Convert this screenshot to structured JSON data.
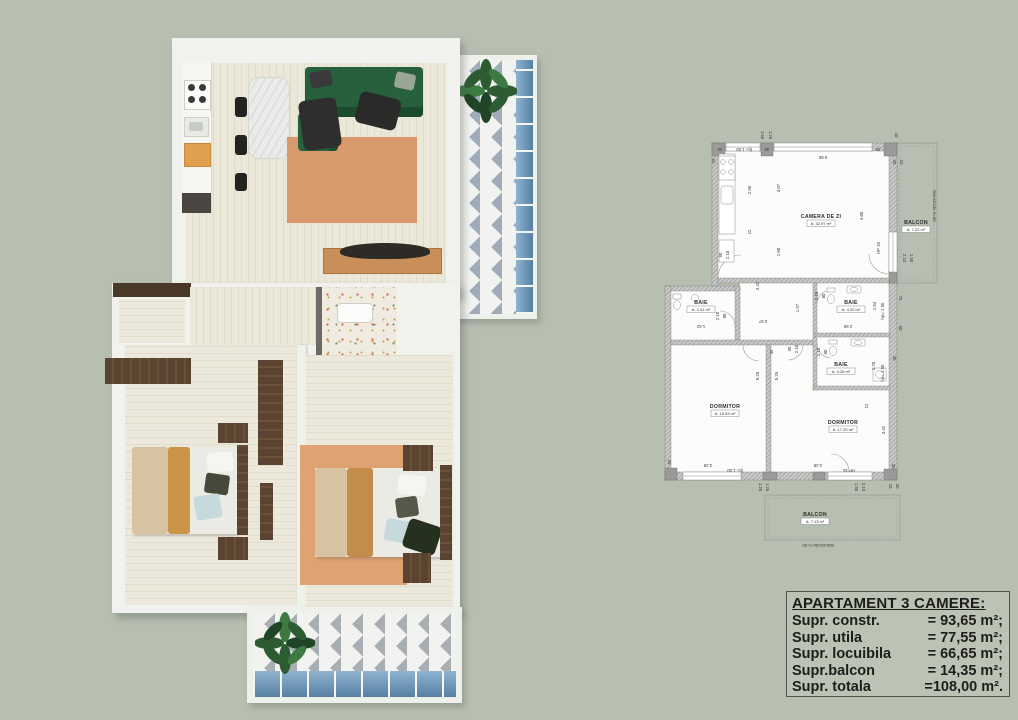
{
  "palette": {
    "page_bg": "#b7bfb1",
    "wall_white": "#f1f2ee",
    "sofa_green": "#26613b",
    "rug_terracotta": "#d89a6c",
    "accent_orange": "#e0a050",
    "dark_wood": "#5a4330",
    "balcony_blue": "#7fa5c4",
    "plan_line": "#8a8a88"
  },
  "plan2d": {
    "rooms": [
      {
        "name": "CAMERA DE ZI",
        "area": "A: 32.97 m²",
        "x": 158,
        "y": 90
      },
      {
        "name": "BAIE",
        "area": "A: 2.41 m²",
        "x": 38,
        "y": 176
      },
      {
        "name": "BAIE",
        "area": "A: 4.20 m²",
        "x": 188,
        "y": 176
      },
      {
        "name": "BAIE",
        "area": "A: 4.28 m²",
        "x": 178,
        "y": 238
      },
      {
        "name": "DORMITOR",
        "area": "A: 16.53 m²",
        "x": 62,
        "y": 280
      },
      {
        "name": "DORMITOR",
        "area": "A: 17.20 m²",
        "x": 180,
        "y": 296
      },
      {
        "name": "BALCON",
        "area": "A: 7.22 m²",
        "x": 253,
        "y": 96
      },
      {
        "name": "BALCON",
        "area": "A: 7.13 m²",
        "x": 152,
        "y": 388
      }
    ],
    "railings": [
      {
        "text": "Balustrada H=90",
        "x": 270,
        "y": 78,
        "rot": 90
      },
      {
        "text": "Balustrada H=90",
        "x": 155,
        "y": 416,
        "rot": 180
      }
    ],
    "dims": [
      {
        "t": "1.50",
        "x": 98,
        "y": 7,
        "r": 90
      },
      {
        "t": "1.25",
        "x": 106,
        "y": 7,
        "r": 90
      },
      {
        "t": "10",
        "x": 232,
        "y": 7,
        "r": 90
      },
      {
        "t": "30",
        "x": 57,
        "y": 20,
        "r": 180
      },
      {
        "t": "fp= 1.00",
        "x": 81,
        "y": 20,
        "r": 180
      },
      {
        "t": "30",
        "x": 104,
        "y": 20,
        "r": 180
      },
      {
        "t": "5.85",
        "x": 160,
        "y": 28,
        "r": 180
      },
      {
        "t": "30",
        "x": 215,
        "y": 20,
        "r": 180
      },
      {
        "t": "30",
        "x": 230,
        "y": 34,
        "r": 90
      },
      {
        "t": "10",
        "x": 237,
        "y": 34,
        "r": 90
      },
      {
        "t": "25",
        "x": 52,
        "y": 33,
        "r": -90
      },
      {
        "t": "2.95",
        "x": 88,
        "y": 62,
        "r": -90
      },
      {
        "t": "3.07",
        "x": 117,
        "y": 60,
        "r": -90
      },
      {
        "t": "12",
        "x": 88,
        "y": 104,
        "r": -90
      },
      {
        "t": "90",
        "x": 59,
        "y": 127,
        "r": -90
      },
      {
        "t": "2.10",
        "x": 66,
        "y": 127,
        "r": -90
      },
      {
        "t": "1.60",
        "x": 117,
        "y": 124,
        "r": -90
      },
      {
        "t": "4.80",
        "x": 200,
        "y": 88,
        "r": -90
      },
      {
        "t": "HP 15",
        "x": 217,
        "y": 120,
        "r": -90
      },
      {
        "t": "2.10",
        "x": 240,
        "y": 130,
        "r": 90
      },
      {
        "t": "1.50",
        "x": 247,
        "y": 130,
        "r": 90
      },
      {
        "t": "3.42",
        "x": 96,
        "y": 158,
        "r": -90
      },
      {
        "t": "1.97",
        "x": 136,
        "y": 180,
        "r": -90
      },
      {
        "t": "2.10",
        "x": 155,
        "y": 168,
        "r": -90
      },
      {
        "t": "80",
        "x": 162,
        "y": 168,
        "r": -90
      },
      {
        "t": "2.87",
        "x": 100,
        "y": 192,
        "r": 180
      },
      {
        "t": "1.62",
        "x": 38,
        "y": 197,
        "r": 180
      },
      {
        "t": "2.10",
        "x": 56,
        "y": 188,
        "r": -90
      },
      {
        "t": "80",
        "x": 63,
        "y": 188,
        "r": -90
      },
      {
        "t": "90",
        "x": 128,
        "y": 221,
        "r": -90
      },
      {
        "t": "2.10",
        "x": 135,
        "y": 221,
        "r": -90
      },
      {
        "t": "2.55",
        "x": 185,
        "y": 197,
        "r": 180
      },
      {
        "t": "1.94",
        "x": 213,
        "y": 178,
        "r": -90
      },
      {
        "t": "hp= 1.50",
        "x": 221,
        "y": 183,
        "r": -90
      },
      {
        "t": "2.10",
        "x": 157,
        "y": 224,
        "r": -90
      },
      {
        "t": "80",
        "x": 164,
        "y": 224,
        "r": -90
      },
      {
        "t": "1.70",
        "x": 212,
        "y": 238,
        "r": -90
      },
      {
        "t": "hp= 1.50",
        "x": 221,
        "y": 245,
        "r": -90
      },
      {
        "t": "12",
        "x": 205,
        "y": 278,
        "r": -90
      },
      {
        "t": "75",
        "x": 236,
        "y": 170,
        "r": 90
      },
      {
        "t": "60",
        "x": 236,
        "y": 200,
        "r": 90
      },
      {
        "t": "30",
        "x": 230,
        "y": 230,
        "r": 90
      },
      {
        "t": "5.25",
        "x": 96,
        "y": 248,
        "r": -90
      },
      {
        "t": "5.25",
        "x": 115,
        "y": 248,
        "r": -90
      },
      {
        "t": "3.42",
        "x": 222,
        "y": 302,
        "r": -90
      },
      {
        "t": "3.28",
        "x": 45,
        "y": 336,
        "r": 180
      },
      {
        "t": "fp= 1.00",
        "x": 72,
        "y": 341,
        "r": 180
      },
      {
        "t": "4.28",
        "x": 155,
        "y": 336,
        "r": 180
      },
      {
        "t": "HP 15",
        "x": 186,
        "y": 341,
        "r": 180
      },
      {
        "t": "25",
        "x": 5,
        "y": 334,
        "r": 90
      },
      {
        "t": "30",
        "x": 229,
        "y": 338,
        "r": 90
      },
      {
        "t": "1.20",
        "x": 96,
        "y": 359,
        "r": 90
      },
      {
        "t": "1.25",
        "x": 103,
        "y": 359,
        "r": 90
      },
      {
        "t": "1.50",
        "x": 192,
        "y": 359,
        "r": 90
      },
      {
        "t": "2.10",
        "x": 199,
        "y": 359,
        "r": 90
      },
      {
        "t": "10",
        "x": 226,
        "y": 358,
        "r": 90
      },
      {
        "t": "20",
        "x": 233,
        "y": 358,
        "r": 90
      },
      {
        "t": "49",
        "x": 110,
        "y": 224,
        "r": -90
      }
    ]
  },
  "info_box": {
    "title": "APARTAMENT 3 CAMERE:",
    "rows": [
      {
        "label": "Supr. constr.",
        "value": "= 93,65 m²;"
      },
      {
        "label": "Supr. utila",
        "value": "= 77,55 m²;"
      },
      {
        "label": "Supr. locuibila",
        "value": "= 66,65 m²;"
      },
      {
        "label": "Supr.balcon",
        "value": "=  14,35 m²;"
      },
      {
        "label": "Supr. totala",
        "value": "=108,00 m²."
      }
    ]
  }
}
